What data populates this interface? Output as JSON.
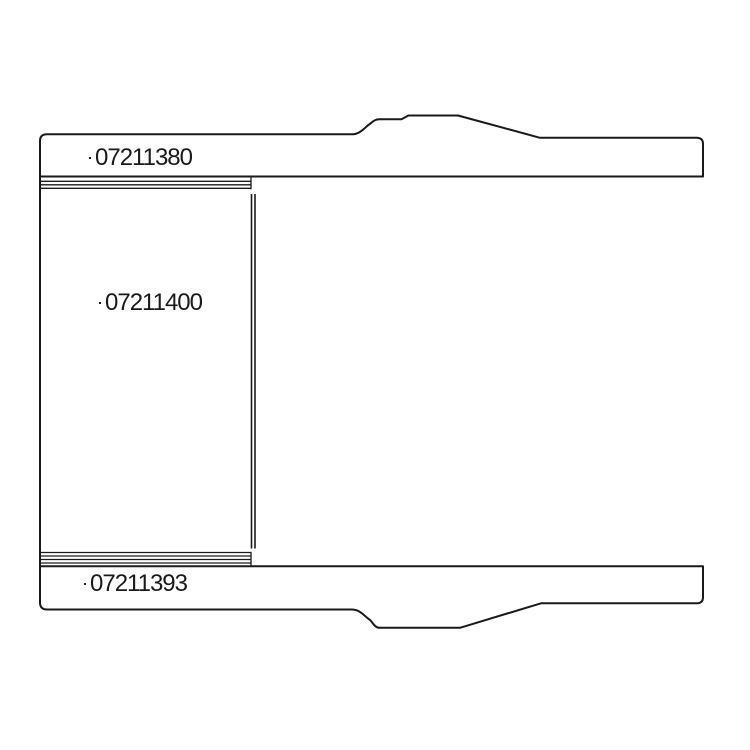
{
  "page": {
    "background": "#ffffff",
    "line_color": "#1a1a1a"
  },
  "diagram": {
    "kind": "technical-parts-line-drawing",
    "parts": [
      {
        "id": "upper-blade",
        "label": "07211380"
      },
      {
        "id": "center-cartridge",
        "label": "07211400"
      },
      {
        "id": "lower-blade",
        "label": "07211393"
      }
    ]
  }
}
